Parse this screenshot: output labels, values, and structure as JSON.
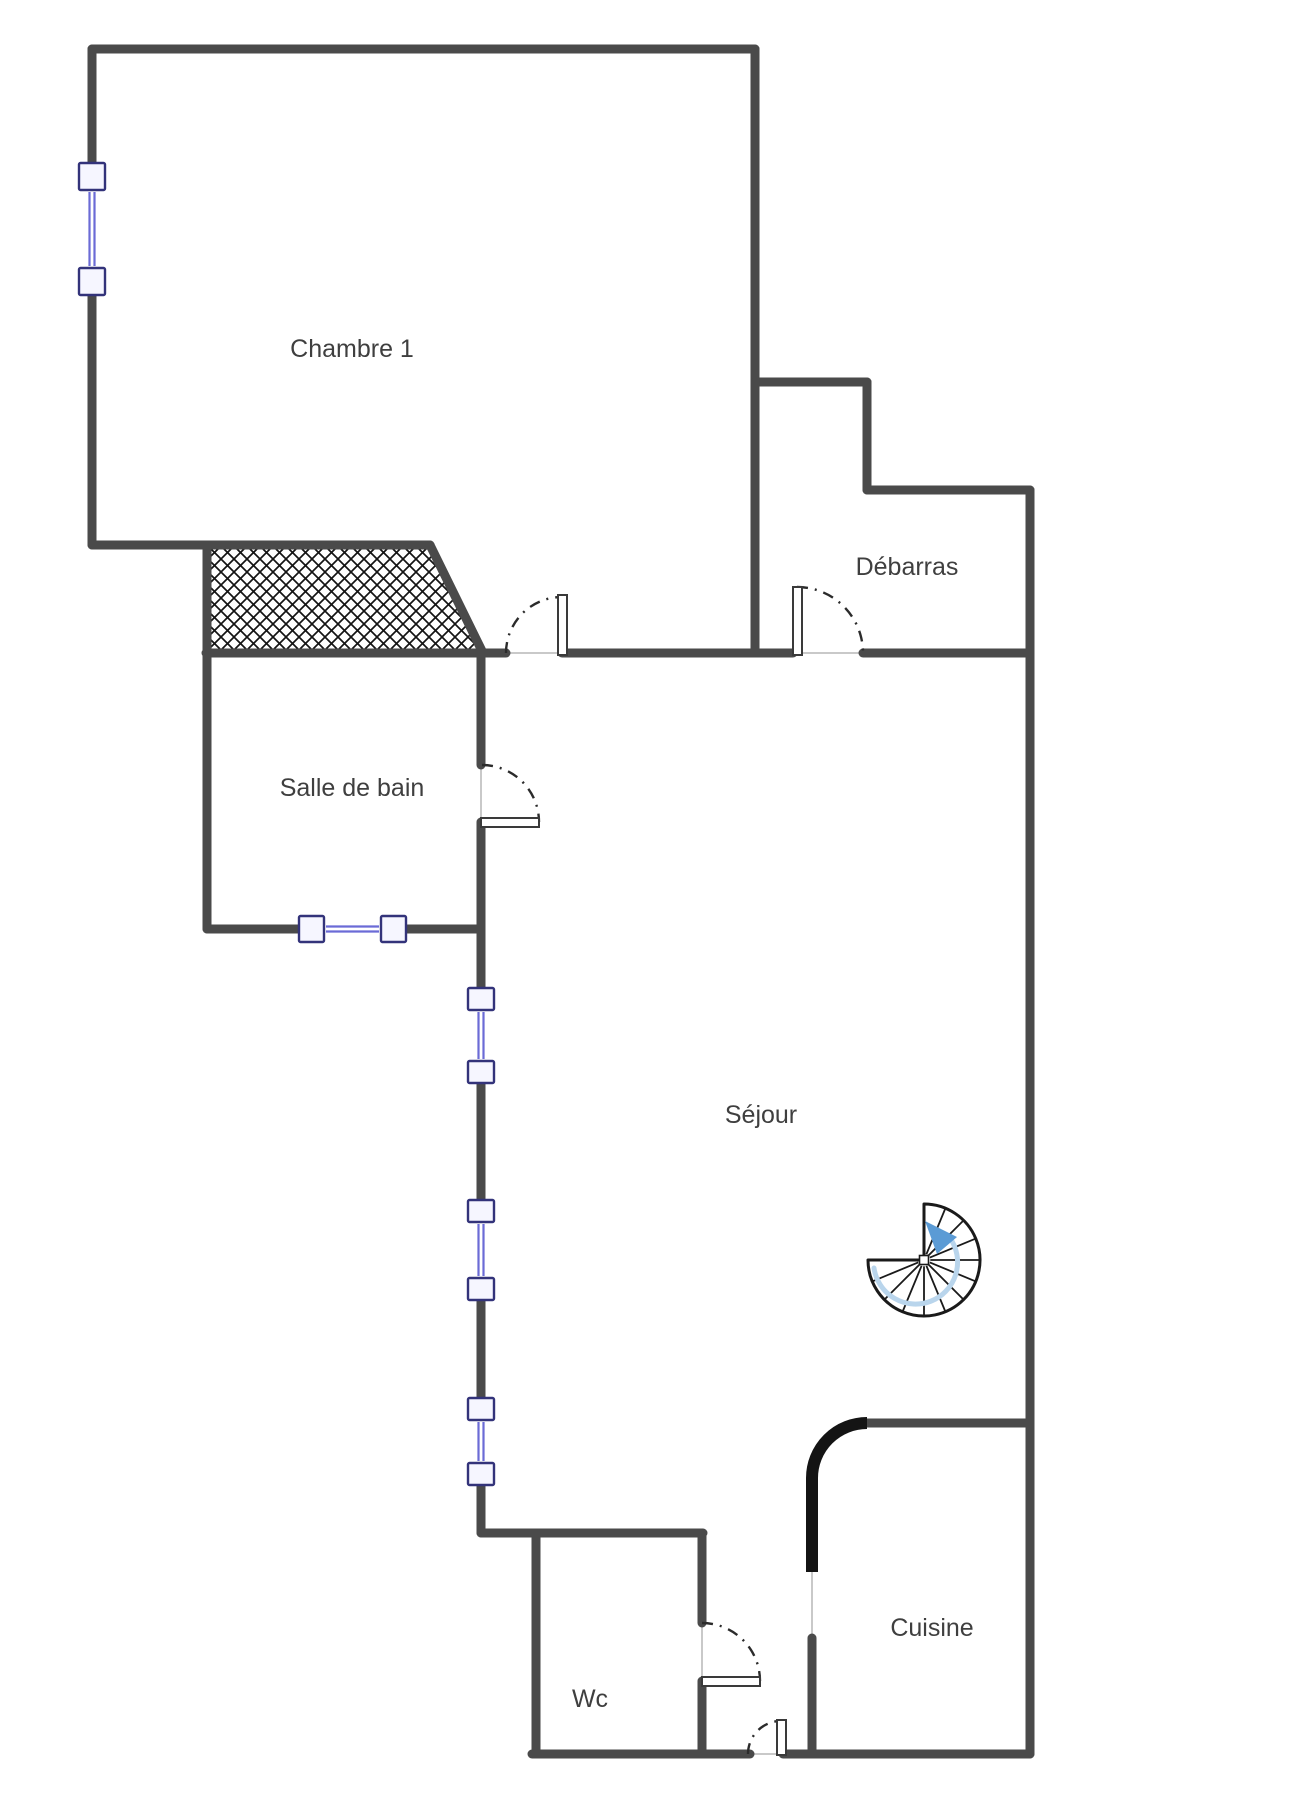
{
  "canvas": {
    "width": 1304,
    "height": 1816,
    "background": "#ffffff"
  },
  "style": {
    "wall_color": "#4a4a4a",
    "wall_width": 9,
    "sill_color": "#c9c9c9",
    "door_arc_color": "#2b2b2b",
    "leaf_fill": "#ffffff",
    "leaf_border": "#3a3a3a",
    "window_frame": "#33337a",
    "window_fill": "#f6f6ff",
    "window_glass": "#6b6bd6",
    "hatch_line": "#141414",
    "black_wall_color": "#141414",
    "label_color": "#3f3f3f",
    "label_size": 25,
    "stair_outline": "#1a1a1a",
    "stair_fill": "#ffffff",
    "stair_arrow": "#5b9bd5",
    "stair_tail": "#b9d5ec"
  },
  "rooms": [
    {
      "id": "chambre-1",
      "label": "Chambre 1",
      "x": 352,
      "y": 348
    },
    {
      "id": "debarras",
      "label": "Débarras",
      "x": 907,
      "y": 566
    },
    {
      "id": "salle-de-bain",
      "label": "Salle de bain",
      "x": 352,
      "y": 787
    },
    {
      "id": "sejour",
      "label": "Séjour",
      "x": 761,
      "y": 1114
    },
    {
      "id": "wc",
      "label": "Wc",
      "x": 590,
      "y": 1698
    },
    {
      "id": "cuisine",
      "label": "Cuisine",
      "x": 932,
      "y": 1627
    }
  ],
  "walls": [
    [
      92,
      49,
      755,
      49
    ],
    [
      92,
      49,
      92,
      163
    ],
    [
      92,
      295,
      92,
      545
    ],
    [
      92,
      545,
      430,
      545
    ],
    [
      430,
      545,
      483,
      653
    ],
    [
      207,
      545,
      207,
      929
    ],
    [
      206,
      653,
      506,
      653
    ],
    [
      562,
      653,
      793,
      653
    ],
    [
      755,
      49,
      755,
      653
    ],
    [
      755,
      382,
      867,
      382
    ],
    [
      867,
      382,
      867,
      490
    ],
    [
      867,
      490,
      1030,
      490
    ],
    [
      1030,
      490,
      1030,
      1754
    ],
    [
      863,
      653,
      1030,
      653
    ],
    [
      207,
      929,
      299,
      929
    ],
    [
      406,
      929,
      481,
      929
    ],
    [
      481,
      653,
      481,
      765
    ],
    [
      481,
      822,
      481,
      988
    ],
    [
      481,
      1083,
      481,
      1200
    ],
    [
      481,
      1300,
      481,
      1398
    ],
    [
      481,
      1485,
      481,
      1533
    ],
    [
      481,
      1533,
      703,
      1533
    ],
    [
      536,
      1533,
      536,
      1754
    ],
    [
      702,
      1533,
      702,
      1623
    ],
    [
      702,
      1681,
      702,
      1754
    ],
    [
      532,
      1754,
      750,
      1754
    ],
    [
      783,
      1754,
      1030,
      1754
    ],
    [
      867,
      1423,
      1030,
      1423
    ],
    [
      812,
      1638,
      812,
      1754
    ]
  ],
  "sills": [
    [
      506,
      653,
      562,
      653
    ],
    [
      793,
      653,
      863,
      653
    ],
    [
      481,
      765,
      481,
      822
    ],
    [
      702,
      1623,
      702,
      1681
    ],
    [
      750,
      1754,
      783,
      1754
    ],
    [
      812,
      1570,
      812,
      1638
    ]
  ],
  "hatch": {
    "points": "207,545 430,545 483,653 207,653",
    "spacing": 13
  },
  "windows": [
    {
      "id": "chambre-window",
      "rects": [
        [
          79,
          163,
          26,
          27
        ],
        [
          79,
          268,
          26,
          27
        ]
      ],
      "glass": [
        92,
        192,
        92,
        266
      ]
    },
    {
      "id": "salle-de-bain-window",
      "rects": [
        [
          299,
          916,
          25,
          26
        ],
        [
          381,
          916,
          25,
          26
        ]
      ],
      "glass": [
        326,
        929,
        379,
        929
      ]
    },
    {
      "id": "sejour-window-1",
      "rects": [
        [
          468,
          988,
          26,
          22
        ],
        [
          468,
          1061,
          26,
          22
        ]
      ],
      "glass": [
        481,
        1012,
        481,
        1059
      ]
    },
    {
      "id": "sejour-window-2",
      "rects": [
        [
          468,
          1200,
          26,
          22
        ],
        [
          468,
          1278,
          26,
          22
        ]
      ],
      "glass": [
        481,
        1224,
        481,
        1276
      ]
    },
    {
      "id": "sejour-window-3",
      "rects": [
        [
          468,
          1398,
          26,
          22
        ],
        [
          468,
          1463,
          26,
          22
        ]
      ],
      "glass": [
        481,
        1422,
        481,
        1461
      ]
    }
  ],
  "doors": [
    {
      "id": "chambre-door",
      "arc": "M 506 653 A 56 56 0 0 1 562 597",
      "leaf": [
        558,
        595,
        9,
        60
      ]
    },
    {
      "id": "debarras-door",
      "arc": "M 797 587 A 66 66 0 0 1 863 653",
      "leaf": [
        793,
        587,
        9,
        68
      ]
    },
    {
      "id": "salle-de-bain-door",
      "arc": "M 482 765 A 57 57 0 0 1 539 822",
      "leaf": [
        481,
        818,
        58,
        9
      ]
    },
    {
      "id": "wc-door",
      "arc": "M 702 1623 A 58 58 0 0 1 760 1681",
      "leaf": [
        702,
        1677,
        58,
        9
      ]
    },
    {
      "id": "entry-door",
      "arc": "M 748 1754 A 33 33 0 0 1 781 1721",
      "leaf": [
        777,
        1720,
        9,
        35
      ]
    }
  ],
  "curved_wall": {
    "arc": "M 812 1478 A 55 55 0 0 1 867 1423",
    "tail": [
      812,
      1478,
      812,
      1572
    ],
    "width": 12
  },
  "stair": {
    "cx": 924,
    "cy": 1260,
    "r": 56,
    "start_deg": -90,
    "end_deg": 180,
    "step_deg": 22.5,
    "hub": 9,
    "tail_path": "M 874 1268 A 42 42 0 1 0 950 1238",
    "arrow_points": "925,1221 957,1237 937,1254"
  }
}
